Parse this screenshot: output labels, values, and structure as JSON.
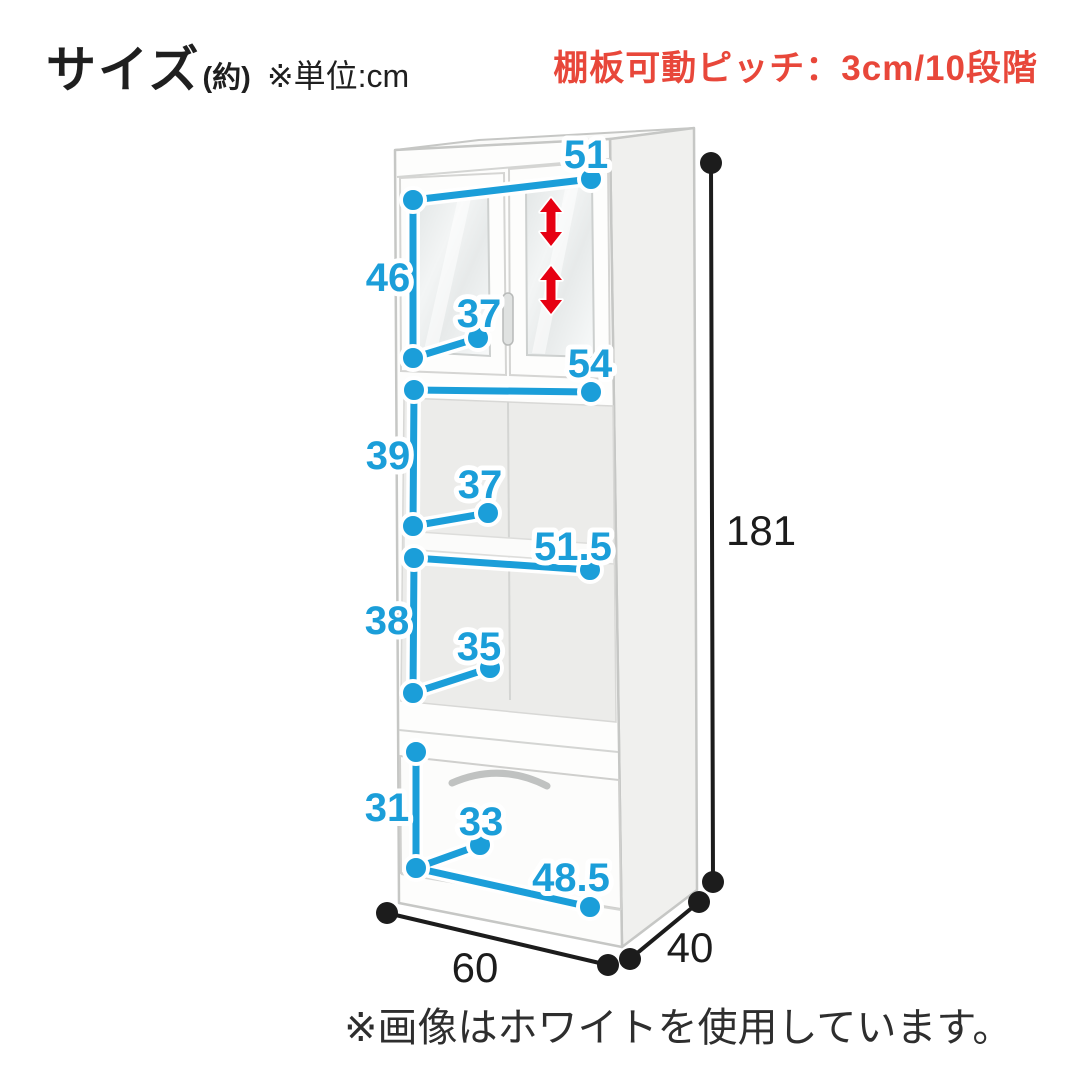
{
  "header": {
    "title": "サイズ",
    "title_suffix": "(約)",
    "unit_note": "※単位:cm",
    "shelf_pitch_note": "棚板可動ピッチ：3cm/10段階"
  },
  "colors": {
    "dimension_blue": "#1b9ed9",
    "note_red": "#e8473a",
    "arrow_red": "#e60012",
    "line_black": "#1c1c1c",
    "background": "#ffffff"
  },
  "dimensions": {
    "upper_door_width": "51",
    "upper_door_height": "46",
    "upper_door_depth": "37",
    "middle_shelf_width": "54",
    "middle_shelf_height": "39",
    "middle_shelf_depth": "37",
    "lower_shelf_width": "51.5",
    "lower_shelf_height": "38",
    "lower_shelf_depth": "35",
    "drawer_height": "31",
    "drawer_depth": "33",
    "drawer_width": "48.5",
    "overall_height": "181",
    "overall_width": "60",
    "overall_depth": "40"
  },
  "footer": {
    "note": "※画像はホワイトを使用しています。"
  }
}
